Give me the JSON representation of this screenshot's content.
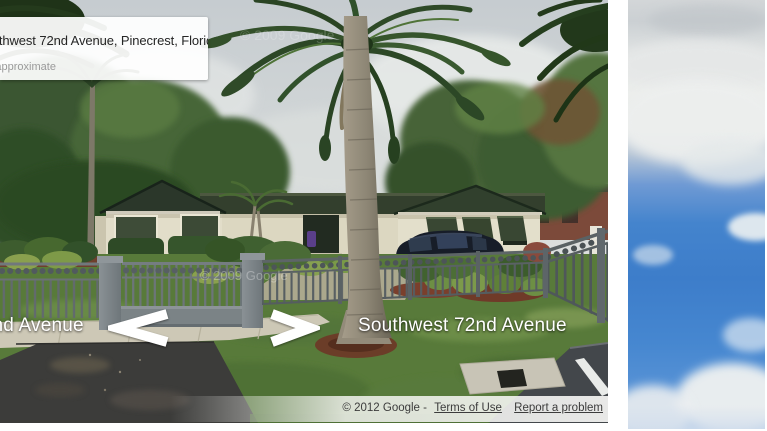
{
  "page": {
    "background": "#ffffff"
  },
  "street_view": {
    "address_card": {
      "title": "Southwest 72nd Avenue, Pinecrest, Florida",
      "subtitle": "Address is approximate"
    },
    "street_label": "Southwest 72nd Avenue",
    "watermark": "© 2009 Google",
    "attribution": {
      "copyright": "© 2012 Google -",
      "terms_link": "Terms of Use",
      "report_link": "Report a problem"
    },
    "nav_arrows": [
      "pan-left",
      "pan-right"
    ],
    "palette": {
      "sky": "#ccd2d5",
      "lawn": "#587a3a",
      "roof": "#2e3a2c",
      "wall": "#e2ddc9",
      "shutter": "#3a4833",
      "fence_gray": "#6f777b",
      "asphalt": "#3c3c3a",
      "mulch": "#6b3d28"
    }
  },
  "sky_image": {
    "palette": {
      "sky_blue": "#3f7ec9",
      "cloud_white": "#eef0ef"
    }
  }
}
